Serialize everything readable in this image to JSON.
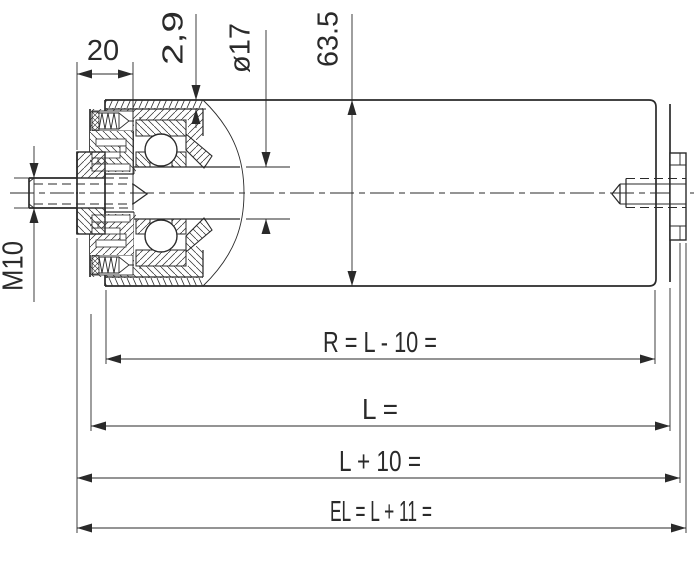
{
  "dims": {
    "offset20": "20",
    "wall_thickness": "2,9",
    "shaft_diameter": "ø17",
    "tube_diameter": "63.5",
    "thread": "M10",
    "radius_length": "R = L - 10 =",
    "tube_length": "L =",
    "length_plus10": "L + 10 =",
    "install_length": "EL = L + 11 ="
  },
  "colors": {
    "line": "#2a2a2a",
    "background": "#ffffff"
  }
}
